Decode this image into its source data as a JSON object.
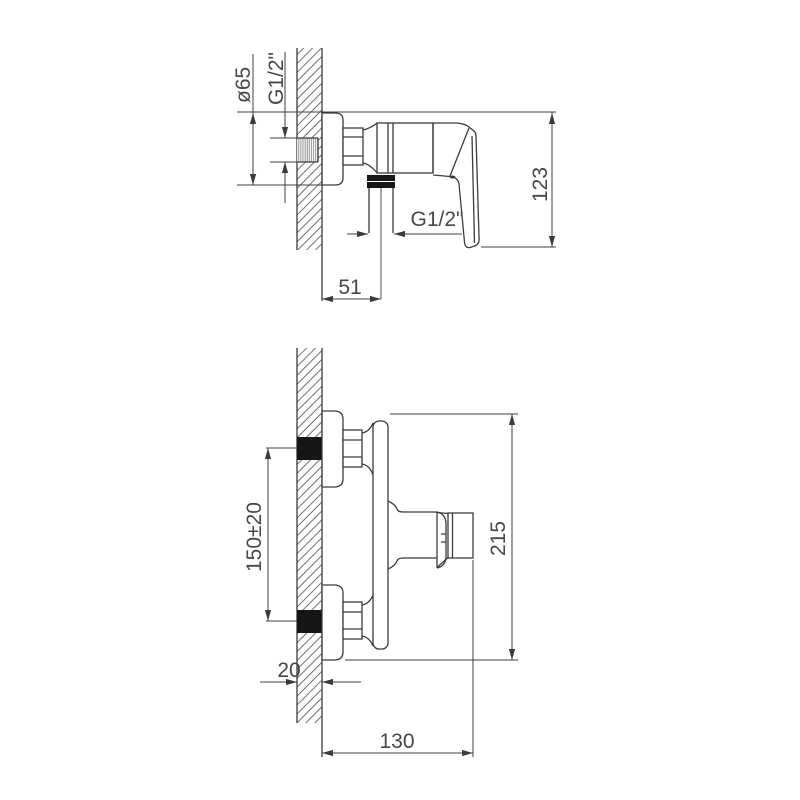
{
  "drawing": {
    "type": "technical-installation-drawing",
    "subject": "wall-mounted shower mixer faucet, two orthographic views with dimensions",
    "colors": {
      "background": "#ffffff",
      "line": "#3b3b3b",
      "text": "#474747",
      "thread_fill": "#161616",
      "hatch": "#555555"
    },
    "views": {
      "side": {
        "name": "side view (top drawing)",
        "dimensions": {
          "flange_diameter": "ø65",
          "inlet_thread": "G1/2\"",
          "body_height": "123",
          "outlet_offset": "51",
          "outlet_thread": "G1/2\""
        }
      },
      "front": {
        "name": "profile view (bottom drawing)",
        "dimensions": {
          "inlet_spacing": "150±20",
          "total_height": "215",
          "wall_thickness": "20",
          "total_depth": "130"
        }
      }
    }
  }
}
